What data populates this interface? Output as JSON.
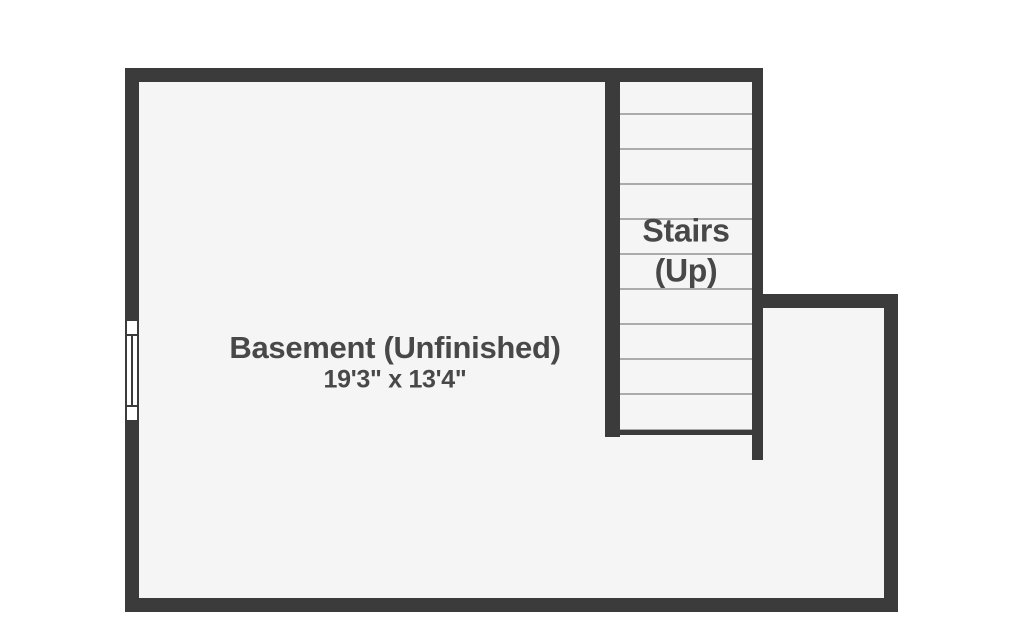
{
  "plan": {
    "room": {
      "label": "Basement (Unfinished)",
      "dimensions": "19'3\" x 13'4\""
    },
    "stairs": {
      "label_line1": "Stairs",
      "label_line2": "(Up)",
      "step_count": 9
    },
    "colors": {
      "wall": "#3b3b3b",
      "floor": "#f5f5f6",
      "step_line": "#ababab",
      "label_text": "#484848",
      "background": "#ffffff"
    }
  }
}
